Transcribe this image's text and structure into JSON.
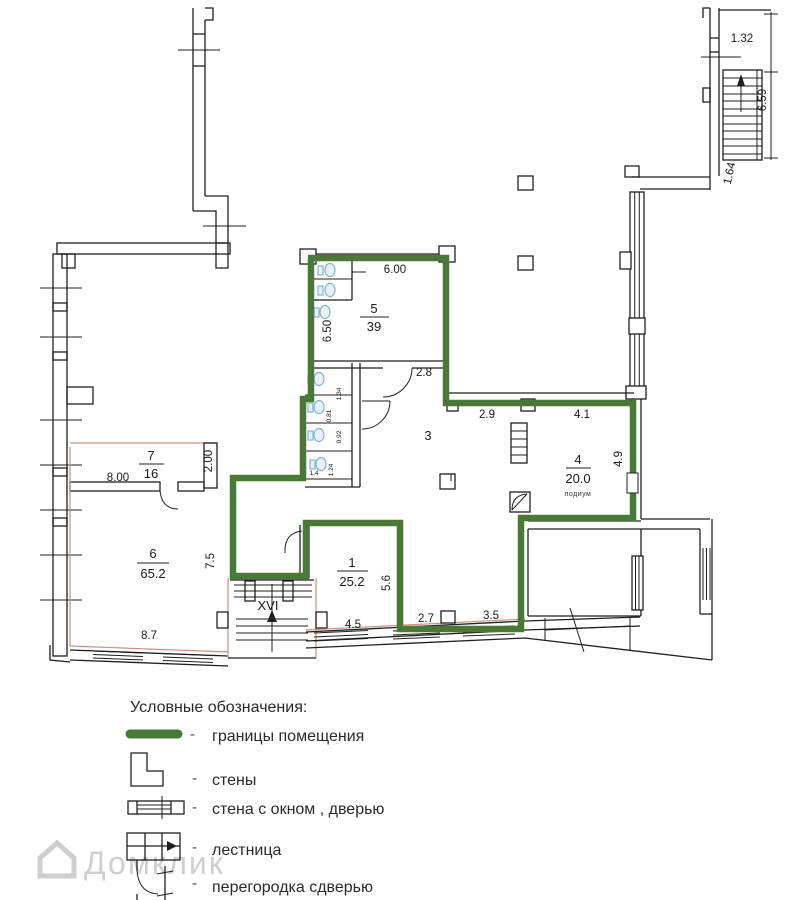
{
  "plan": {
    "rooms": {
      "r5": {
        "num": "5",
        "area": "39"
      },
      "r3": {
        "num": "3"
      },
      "r4": {
        "num": "4",
        "area": "20.0",
        "note": "подиум"
      },
      "r7": {
        "num": "7",
        "area": "16"
      },
      "r6": {
        "num": "6",
        "area": "65.2"
      },
      "r1": {
        "num": "1",
        "area": "25.2"
      }
    },
    "stair_label": "XVI",
    "dims": {
      "w132": "1.32",
      "h659": "6.59",
      "h164": "1.64",
      "w600": "6.00",
      "h650": "6.50",
      "w28": "2.8",
      "w29": "2.9",
      "w41": "4.1",
      "h49": "4.9",
      "w800": "8.00",
      "h200": "2.00",
      "h75": "7.5",
      "w87": "8.7",
      "h56": "5.6",
      "w45": "4.5",
      "w27": "2.7",
      "w35": "3.5",
      "b134": "1.34",
      "b081": "0.81",
      "b092": "0.92",
      "b14": "1.4",
      "b124": "1.24"
    }
  },
  "legend": {
    "title": "Условные обозначения:",
    "dash": "-",
    "items": [
      {
        "label": "границы помещения",
        "symbol": "room-boundary-line"
      },
      {
        "label": "стены",
        "symbol": "wall-corner"
      },
      {
        "label": "стена с окном , дверью",
        "symbol": "wall-with-window-door"
      },
      {
        "label": "лестница",
        "symbol": "staircase"
      },
      {
        "label": "перегородка сдверью",
        "symbol": "partition-with-door"
      }
    ]
  },
  "watermark": {
    "text": "Домклик"
  },
  "colors": {
    "boundary": "#4a7836",
    "wall": "#1f1f1f",
    "original_outline": "#c9907e",
    "fixture": "#85b3d6",
    "watermark": "#cfcfcf"
  }
}
